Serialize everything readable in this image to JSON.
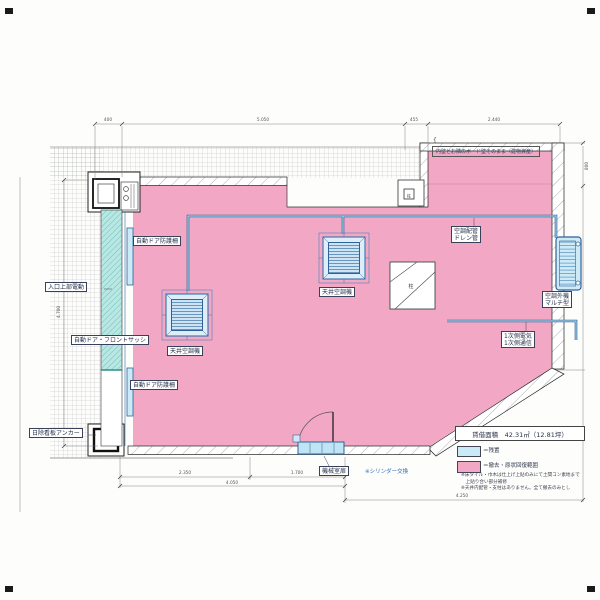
{
  "drawing": {
    "note_top_right": "内壁とお隣のボード壁そのまま（建物資産）",
    "note_brace": "{",
    "labels": {
      "auto_door_guard": "自動ドア防護柵",
      "entrance_upper_motor": "入口上部電動",
      "auto_door_front_sash": "自動ドア・フロントサッシ",
      "signboard_anchor": "日除看板アンカー",
      "ceiling_ac": "天井空調機",
      "ac_piping_1": "空調配管",
      "ac_piping_2": "ドレン管",
      "outdoor_unit_1": "空調外機",
      "outdoor_unit_2": "マルチ型",
      "primary_power_1": "1次側電気",
      "primary_power_2": "1次側通信",
      "machine_room_door": "機械室扉",
      "cylinder_note": "※シリンダー交換",
      "column": "柱"
    },
    "legend": {
      "area": "賃借面積　42.31㎡（12.81坪）",
      "blue": "＝残置",
      "pink": "＝撤去・原状回復範囲",
      "note_1": "※床タイル・巾木は仕上げ上貼のみにて土間コン素地まで",
      "note_2": "　上貼り合い部分補修",
      "note_3": "※天井内配管・支柱はありません。全て撤去のみとし"
    },
    "dims": {
      "top_1": "400",
      "top_2": "5.050",
      "top_3": "455",
      "top_4": "2.440",
      "bottom_1": "2.350",
      "bottom_2": "1.700",
      "bottom_total": "4.050",
      "bottom_right": "4.250",
      "left": "4.700",
      "right": "800"
    },
    "colors": {
      "restore_pink": "#f2a7c4",
      "keep_blue": "#c9eaf6",
      "pipe_blue": "#3f7db5",
      "sash_teal": "#b9e7e3"
    }
  }
}
